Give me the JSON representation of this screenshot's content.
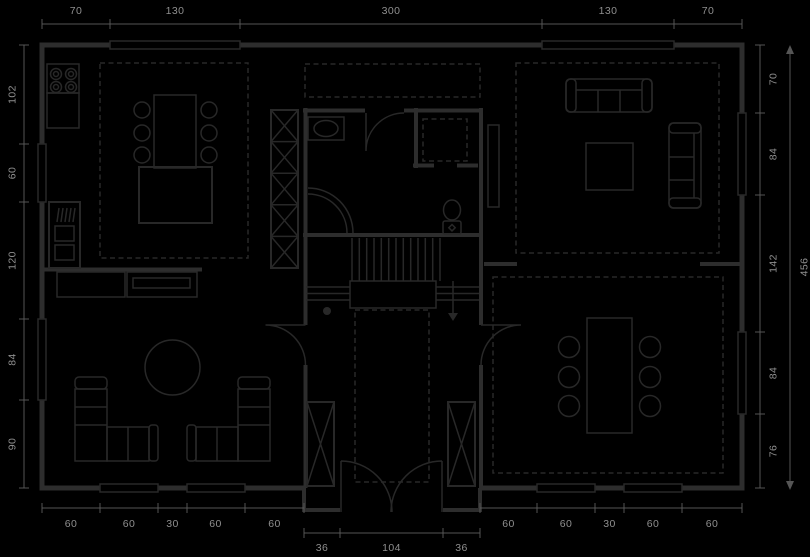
{
  "palette": {
    "background": "#000000",
    "wall": "#2d2d2d",
    "furniture": "#282828",
    "dimension_line": "#555555",
    "dimension_text": "#8f8f8f"
  },
  "dimensions": {
    "top": {
      "labels": [
        "70",
        "130",
        "300",
        "130",
        "70"
      ]
    },
    "left": {
      "labels": [
        "102",
        "60",
        "120",
        "84",
        "90"
      ]
    },
    "right": {
      "labels": [
        "70",
        "84",
        "142",
        "84",
        "76"
      ],
      "total": "456"
    },
    "bottom_left": {
      "labels": [
        "60",
        "60",
        "30",
        "60",
        "60"
      ]
    },
    "bottom_right": {
      "labels": [
        "60",
        "60",
        "30",
        "60",
        "60"
      ]
    },
    "entry": {
      "labels": [
        "36",
        "104",
        "36"
      ]
    }
  }
}
